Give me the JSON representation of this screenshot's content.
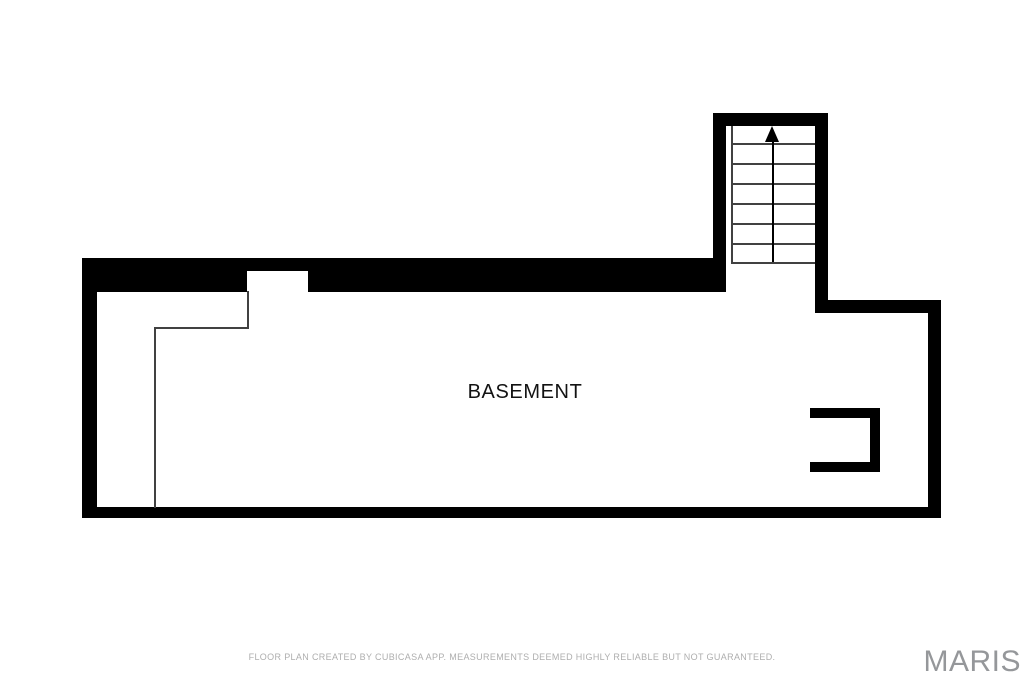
{
  "page": {
    "width": 1024,
    "height": 682,
    "background": "#ffffff"
  },
  "floor_plan": {
    "room_label": "BASEMENT",
    "label_color": "#121212",
    "wall_color": "#000000",
    "thin_line_color": "#414141",
    "walls": [
      {
        "name": "top-wall-left",
        "x": 82,
        "y": 258,
        "w": 165,
        "h": 34
      },
      {
        "name": "top-wall-window-segment",
        "x": 247,
        "y": 258,
        "w": 61,
        "h": 13
      },
      {
        "name": "top-wall-right",
        "x": 308,
        "y": 258,
        "w": 415,
        "h": 34
      },
      {
        "name": "left-wall",
        "x": 82,
        "y": 258,
        "w": 15,
        "h": 260
      },
      {
        "name": "bottom-wall",
        "x": 82,
        "y": 507,
        "w": 859,
        "h": 11
      },
      {
        "name": "right-wall",
        "x": 928,
        "y": 300,
        "w": 13,
        "h": 218
      },
      {
        "name": "right-section-top-wall",
        "x": 815,
        "y": 300,
        "w": 126,
        "h": 13
      },
      {
        "name": "stairwell-top-wall",
        "x": 713,
        "y": 113,
        "w": 115,
        "h": 13
      },
      {
        "name": "stairwell-left-wall",
        "x": 713,
        "y": 113,
        "w": 13,
        "h": 179
      },
      {
        "name": "stairwell-right-wall",
        "x": 815,
        "y": 113,
        "w": 13,
        "h": 200
      },
      {
        "name": "alcove-top-wall",
        "x": 810,
        "y": 408,
        "w": 70,
        "h": 10
      },
      {
        "name": "alcove-right-wall",
        "x": 870,
        "y": 408,
        "w": 10,
        "h": 64
      },
      {
        "name": "alcove-bottom-wall",
        "x": 810,
        "y": 462,
        "w": 70,
        "h": 10
      }
    ],
    "thin_lines": [
      {
        "name": "interior-partition-line-vertical-left",
        "x": 154,
        "y": 327,
        "w": 2,
        "h": 181
      },
      {
        "name": "interior-partition-line-horizontal",
        "x": 154,
        "y": 327,
        "w": 95,
        "h": 2
      },
      {
        "name": "interior-partition-line-vertical-right",
        "x": 247,
        "y": 291,
        "w": 2,
        "h": 38
      },
      {
        "name": "stair-side-line",
        "x": 731,
        "y": 126,
        "w": 2,
        "h": 138
      }
    ],
    "stairs": {
      "name": "staircase",
      "direction": "up",
      "step_count": 7,
      "steps_x": 731,
      "steps_w": 84,
      "step_lines_y": [
        143,
        163,
        183,
        203,
        223,
        243,
        262
      ],
      "arrow": {
        "icon": "up-arrow-icon",
        "x": 773,
        "tip_y": 126,
        "base_y": 142,
        "line_bottom_y": 262
      }
    }
  },
  "footer": {
    "disclaimer": "FLOOR PLAN CREATED BY CUBICASA APP. MEASUREMENTS DEEMED HIGHLY RELIABLE BUT NOT GUARANTEED.",
    "color": "#aeaeae"
  },
  "branding": {
    "logo_text": "MARIS",
    "color": "#95979a"
  }
}
